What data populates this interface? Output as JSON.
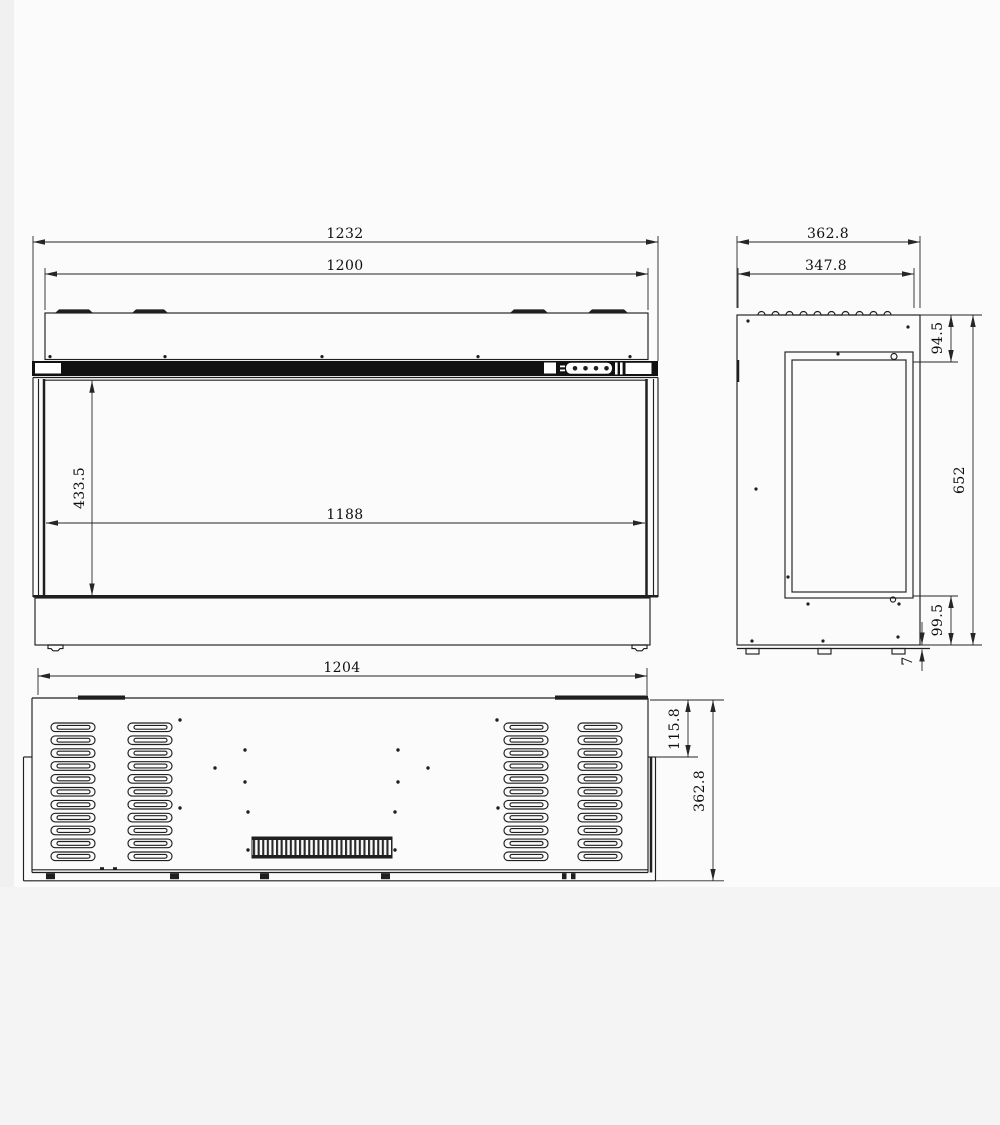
{
  "meta": {
    "type": "technical-drawing-three-views",
    "line_color": "#1f1f1f",
    "background": "#fbfbfc",
    "panel_color": "#111111"
  },
  "dims": {
    "front_overall_width": "1232",
    "front_body_width": "1200",
    "front_opening_height": "433.5",
    "front_opening_width": "1188",
    "side_overall_depth": "362.8",
    "side_body_depth": "347.8",
    "side_top_inset": "94.5",
    "side_overall_height": "652",
    "side_base_height": "99.5",
    "side_bottom_lip": "7",
    "bottom_overall_width": "1204",
    "bottom_side_inset": "115.8",
    "bottom_overall_depth": "362.8"
  }
}
